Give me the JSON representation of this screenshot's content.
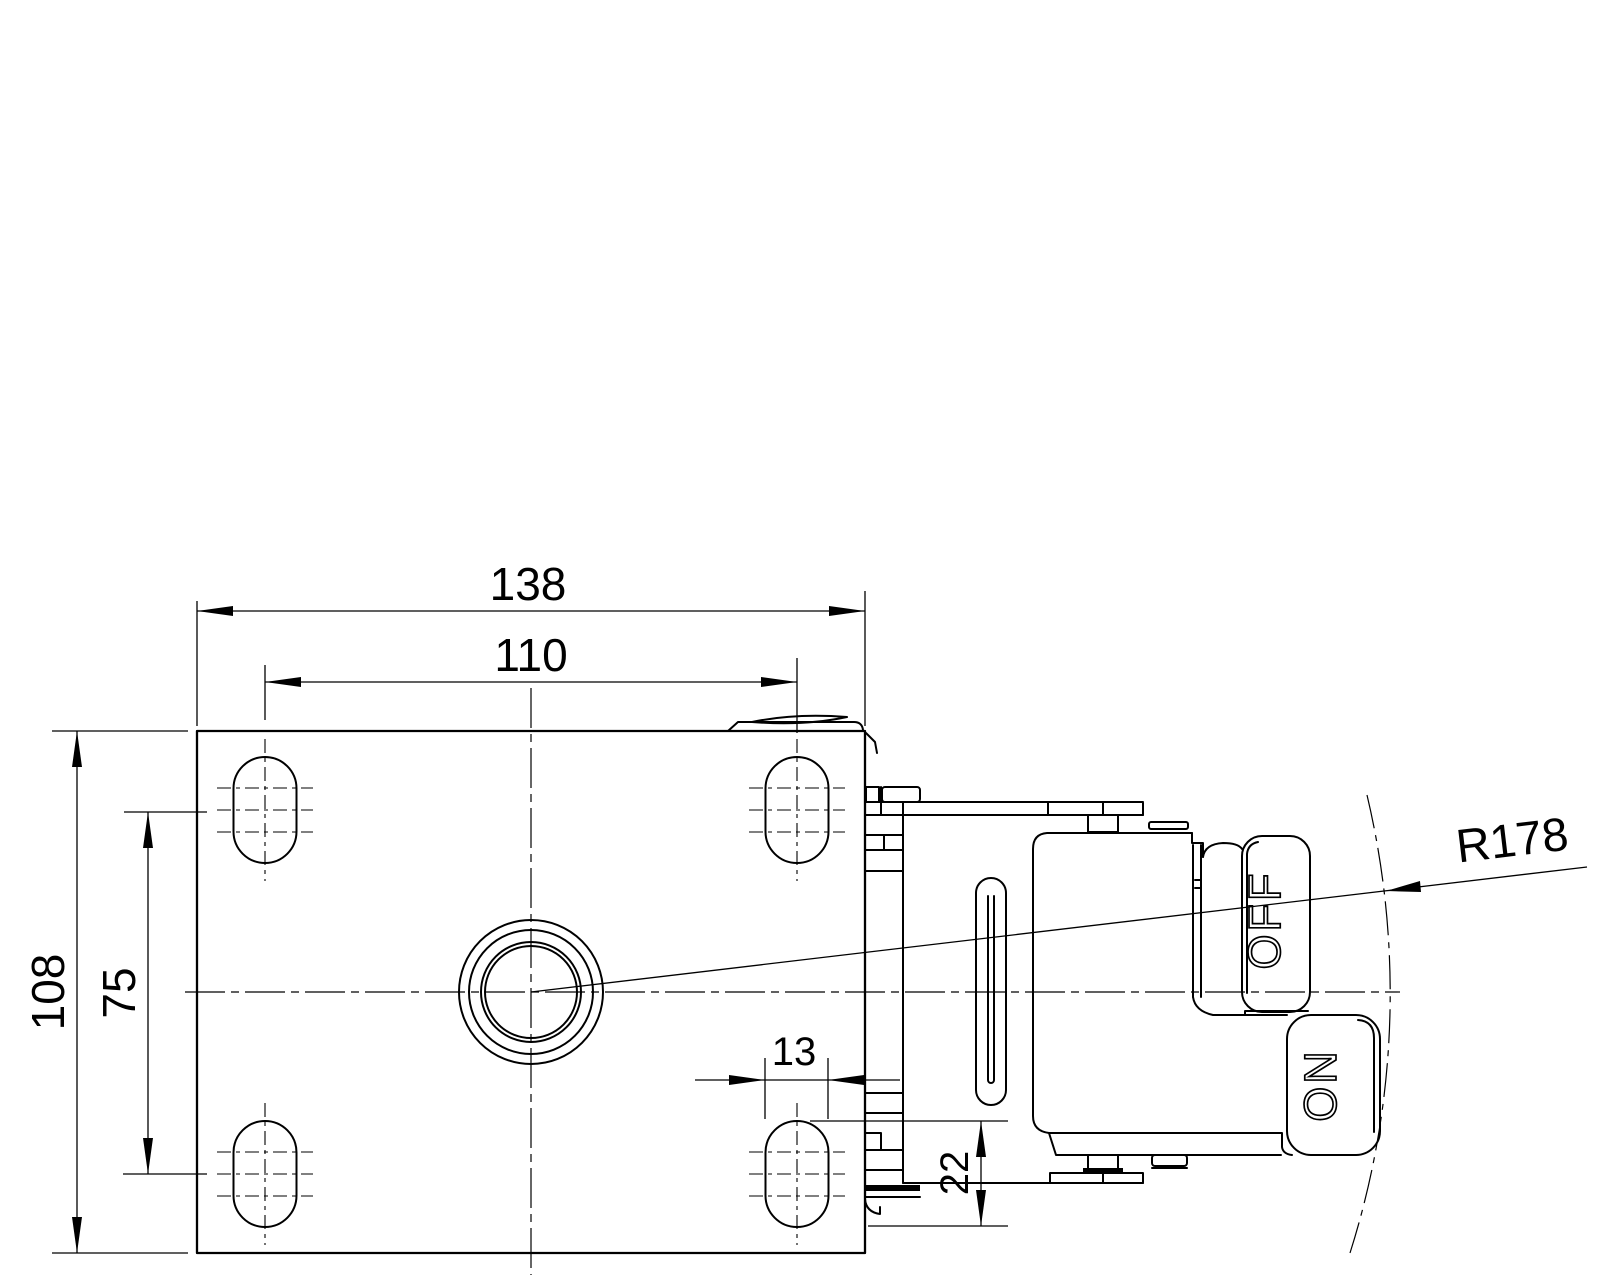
{
  "drawing": {
    "type": "technical-drawing",
    "views": [
      "top view of mounting plate",
      "side view of brake pedal mechanism"
    ],
    "colors": {
      "line": "#000000",
      "background": "#ffffff"
    },
    "dims": {
      "plate_width": "138",
      "slot_pitch_width": "110",
      "plate_depth": "108",
      "slot_pitch_depth": "75",
      "slot_width": "13",
      "slot_length": "22",
      "swing_radius": "R178"
    },
    "pedal": {
      "off": "OFF",
      "on": "ON"
    }
  }
}
